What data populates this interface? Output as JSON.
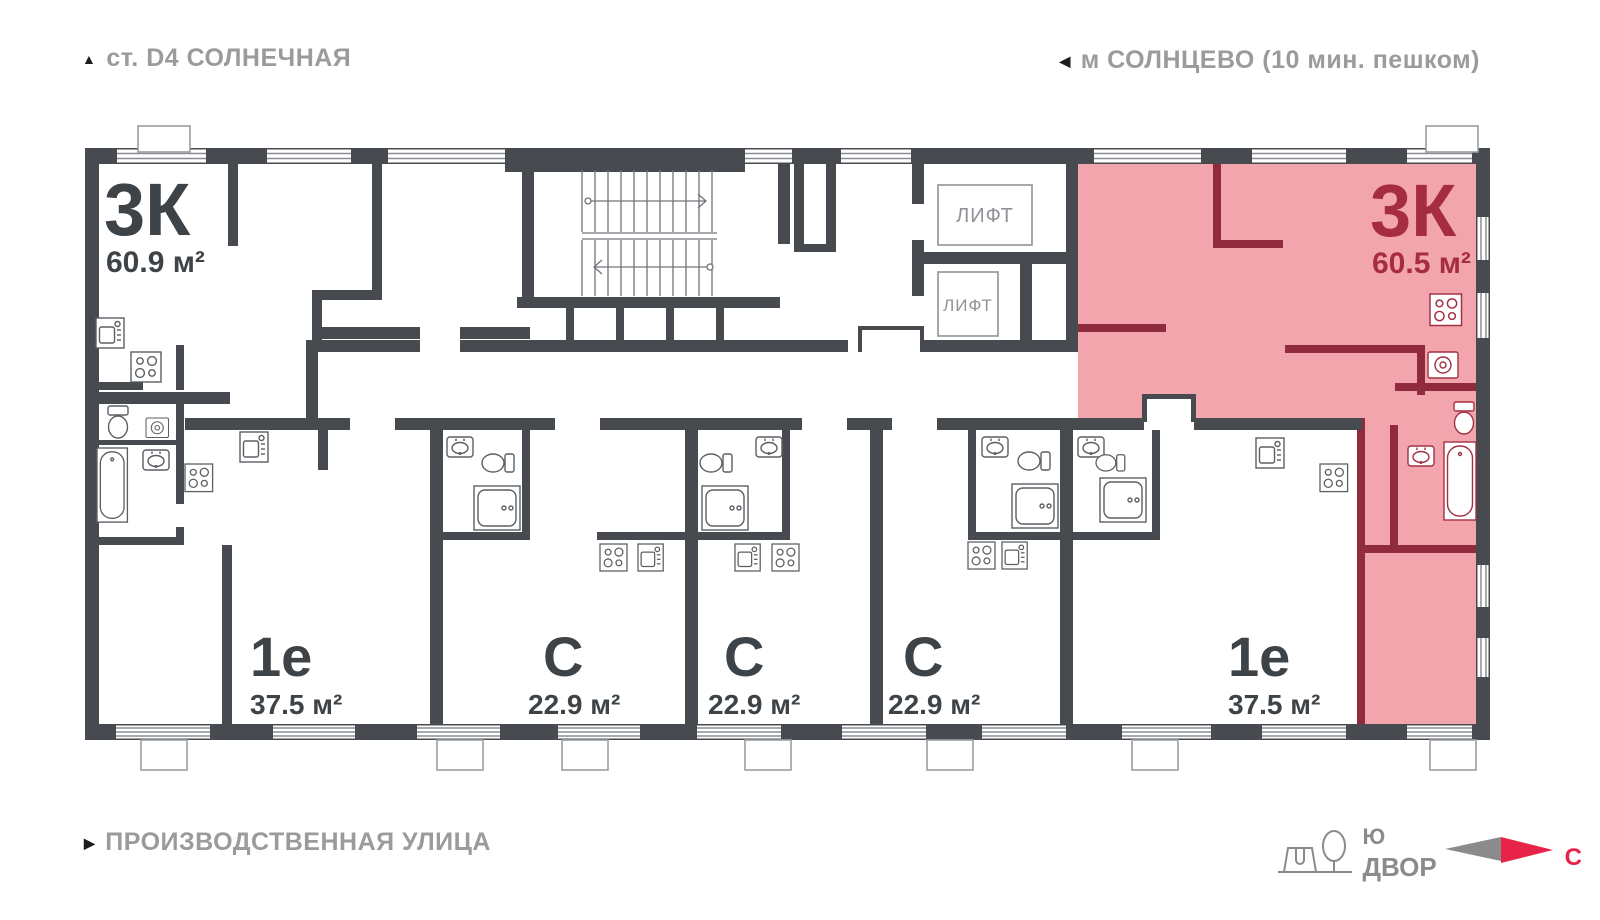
{
  "header": {
    "station": "ст. D4 СОЛНЕЧНАЯ",
    "metro": "м СОЛНЦЕВО (10 мин. пешком)"
  },
  "footer": {
    "street": "ПРОИЗВОДСТВЕННАЯ УЛИЦА"
  },
  "compass": {
    "south": "Ю",
    "yard": "ДВОР",
    "north": "С"
  },
  "elevators": [
    {
      "label": "ЛИФТ"
    },
    {
      "label": "ЛИФТ"
    }
  ],
  "apartments": [
    {
      "id": "apt-3k-left",
      "type": "3К",
      "area": "60.9 м²",
      "highlighted": false
    },
    {
      "id": "apt-1e-left",
      "type": "1е",
      "area": "37.5 м²",
      "highlighted": false
    },
    {
      "id": "studio-1",
      "type": "С",
      "area": "22.9 м²",
      "highlighted": false
    },
    {
      "id": "studio-2",
      "type": "С",
      "area": "22.9 м²",
      "highlighted": false
    },
    {
      "id": "studio-3",
      "type": "С",
      "area": "22.9 м²",
      "highlighted": false
    },
    {
      "id": "apt-1e-right",
      "type": "1е",
      "area": "37.5 м²",
      "highlighted": false
    },
    {
      "id": "apt-3k-right",
      "type": "3К",
      "area": "60.5 м²",
      "highlighted": true
    }
  ],
  "icons": [
    "stove-icon",
    "kitchen-sink-icon",
    "bath-sink-icon",
    "toilet-icon",
    "shower-icon",
    "bathtub-icon",
    "washer-icon",
    "tree-icon",
    "north-arrow-icon",
    "direction-triangle-icon"
  ],
  "colors": {
    "wall": "#474b4f",
    "highlight_fill": "#f3a5ae",
    "highlight_wall": "#8f2b3d",
    "highlight_text": "#a52c41",
    "label_text": "#3e4347",
    "muted_text": "#9b9b9b",
    "north_red": "#e8234a",
    "fixture_stroke": "#5a5f63"
  }
}
